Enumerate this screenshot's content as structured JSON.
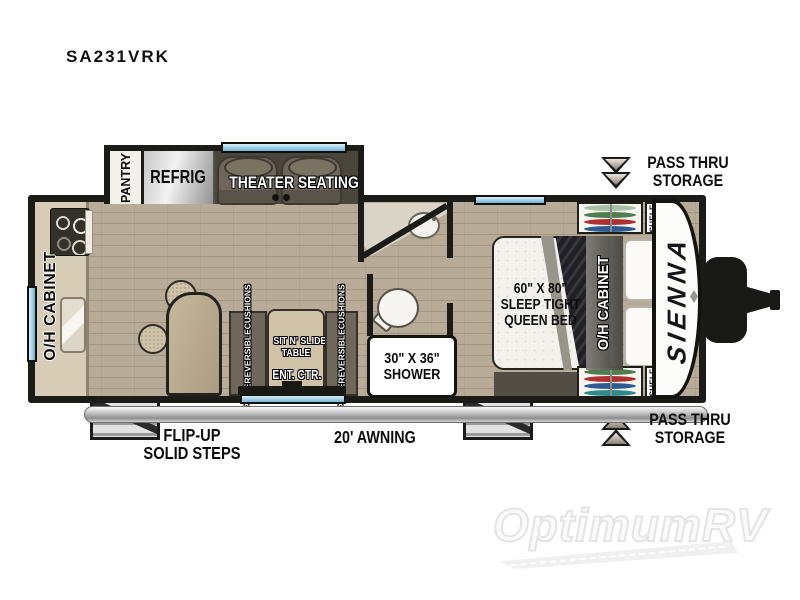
{
  "title": "SA231VRK",
  "watermark": "OptimumRV",
  "colors": {
    "wall": "#1b1b18",
    "floor": "#b8ab97",
    "window_blue": "#74b4d6",
    "furniture_taupe": "#6e665a",
    "counter": "#d7cdb6",
    "hanger_green": "#4e7d4e",
    "hanger_red": "#ae3030",
    "hanger_blue": "#2e5c92"
  },
  "slideout": {
    "pantry": "PANTRY",
    "refrigerator": "REFRIG",
    "theater_seating": "THEATER SEATING"
  },
  "kitchen": {
    "oh_cabinet": "O/H CABINET"
  },
  "living": {
    "cushion_left": [
      "FLIPSIDE",
      "REVERSIBLE",
      "CUSHIONS"
    ],
    "cushion_right": [
      "FLIPSIDE",
      "REVERSIBLE",
      "CUSHIONS"
    ],
    "slide_table": [
      "SIT N' SLIDE",
      "TABLE"
    ],
    "ent_center": "ENT. CTR."
  },
  "bathroom": {
    "shower_size": "30\" X 36\"",
    "shower": "SHOWER"
  },
  "bedroom": {
    "bed_line1": "60\" X 80\"",
    "bed_line2": "SLEEP TIGHT",
    "bed_line3": "QUEEN BED",
    "oh_cabinet": "O/H CABINET",
    "shelf_top": "SHELF",
    "shelf_bottom": "SHELF"
  },
  "exterior": {
    "pass_thru_top": [
      "PASS THRU",
      "STORAGE"
    ],
    "pass_thru_bottom": [
      "PASS THRU",
      "STORAGE"
    ],
    "steps": [
      "FLIP-UP",
      "SOLID STEPS"
    ],
    "awning": "20' AWNING",
    "brand": "SIENNA"
  }
}
